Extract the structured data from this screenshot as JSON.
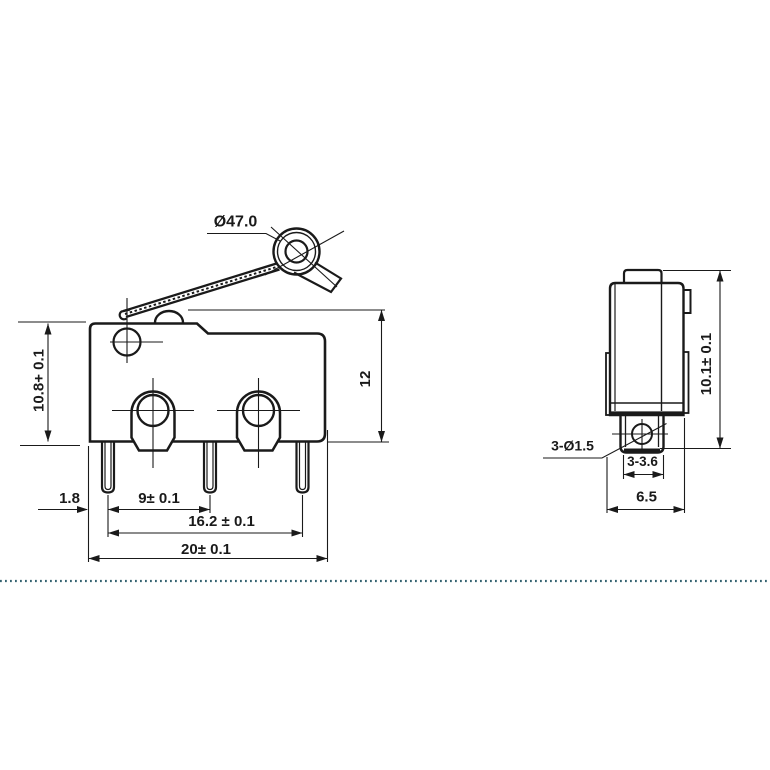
{
  "front_view": {
    "labels": {
      "roller_diameter": "Ø47.0",
      "body_height": "10.8+ 0.1",
      "overall_height": "12",
      "pin_edge_offset": "1.8",
      "pin_pitch_1": "9± 0.1",
      "pin_pitch_2": "16.2 ± 0.1",
      "body_width": "20± 0.1"
    }
  },
  "side_view": {
    "labels": {
      "terminal_holes": "3-Ø1.5",
      "terminal_width": "3-3.6",
      "body_depth": "6.5",
      "body_height": "10.1± 0.1"
    }
  },
  "colors": {
    "line": "#1a1a1a",
    "separator_dotted_line": "#34626f",
    "background": "#ffffff"
  }
}
